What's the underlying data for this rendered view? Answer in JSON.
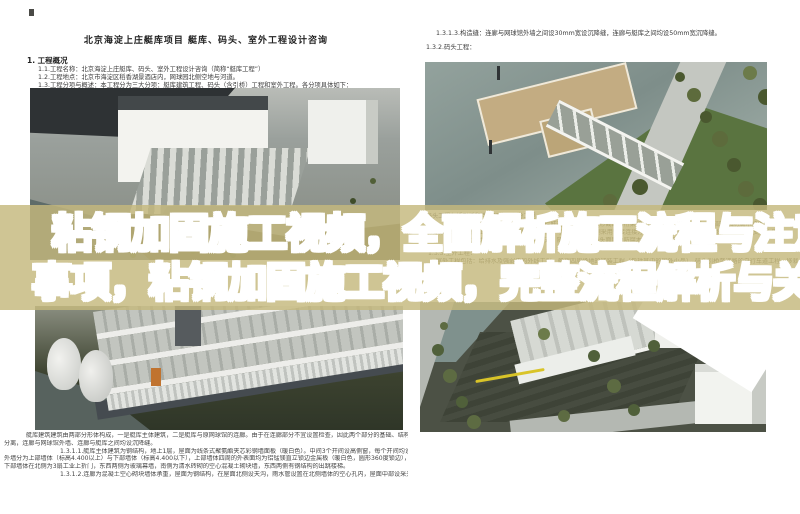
{
  "overlay": {
    "line1": "粘钢加固施工视频，全面解析施工流程与注意",
    "line2": "事项，粘钢加固施工视频，完整流程解析与关",
    "band_color": "#c5b87c",
    "text_fill_top": "#bdab66",
    "text_fill_bottom": "#ffffff",
    "text_outline": "#ffffff"
  },
  "left_page": {
    "title": "北京海淀上庄艇库项目 艇库、码头、室外工程设计咨询",
    "section_heading": "1.  工程概况",
    "intro_lines": [
      "1.1.工程名称：北京海淀上庄艇库、码头、室外工程设计咨询（简称“艇库工程”）",
      "1.2.工程地点：北京市海淀区稻香湖景酒店内，网球园北侧空地与河道。",
      "1.3.工程分项与概述：本工程分为三大分项：艇库建筑工程、码头（含引桥）工程和室外工程。各分项具体如下："
    ],
    "bottom_lines": [
      "艇库建筑建筑由两部分形体构成，一是艇库主体建筑，二是艇库与原网球馆的连廊。由于在连廊部分不宜设置检查，因此两个部分的基础、结构",
      "分离，连廊与网球馆外墙、连廊与艇库之间均设沉降缝。",
      "1.3.1.1.艇库主体建筑为钢结构，地上1层，屋面为线条式聚氨酯夹芯彩钢墙面板（暖白色）。中间3个开间设高侧窗，每个开间均设排水天沟，",
      "外墙分为上部墙体（标高4.400以上）与下部墙体（标高4.400以下），上部墙体四周的外表面均为铝锰镁直立锁边金属板（暖白色，圆形360度锁边），",
      "下部墙体在北侧为3扇工业上折门，东西两侧为玻璃幕墙，南侧为清水砖砌的空心混凝土砌块墙，东西两侧有钢结构的出跳楼梯。",
      "1.3.1.2.连廊为混凝土空心砌块墙体承重，屋面为钢结构，在屋面北侧设天沟，雨水管设置在北侧墙体的空心孔内，屋面中部设采光天窗。"
    ]
  },
  "right_page": {
    "top_lines": [
      "1.3.1.3.构造缝：连廊与网球馆外墙之间设30mm宽设沉降缝，连廊与艇库之间均设50mm宽沉降缝。",
      "1.3.2.码头工程："
    ],
    "caption": "码头工程包括引桥和浮动码头两部分工程。",
    "under_band_lines": [
      "1.3.2.1.引桥为钢结构，两侧为利用栏杆高度设计的三角形截面的桁架梁，梁的上弦杆作为扶手（局部附加防腐木扶手板）。三角形桁架梁之间",
      "桁架梁之间，在桥面上铺设玻璃钢格栅铺装面层，引桥在码头一侧采用铰接连接方式，固定在岸侧的墩台上桥墩上竖向滑动支座上采。",
      "1.3.2.2.浮动码头为钢结构组合浮箱式，随水位升降，码头面层为防腐木铺装（包括其中的系船设施）。",
      "1.3.3.室外工程：",
      "室外工程包括：给排水及强弱电的外线工程，艇库四周场地的铺装工程（包括其中的室外小品），码头引桥至道路的自行车道工程，移栽及新种树木"
    ]
  }
}
